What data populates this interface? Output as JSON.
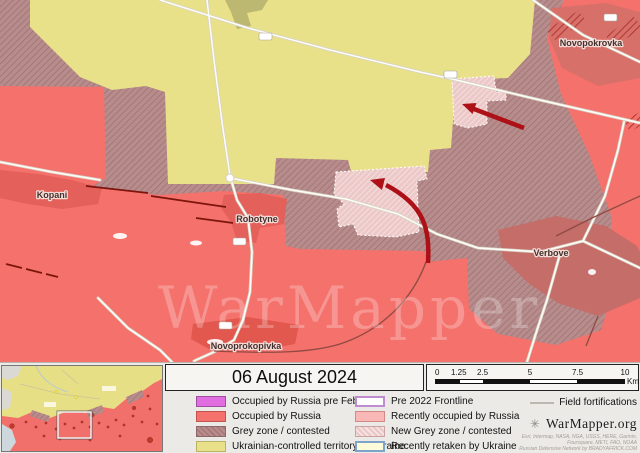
{
  "map": {
    "watermark": "WarMapper",
    "labels": {
      "kopani": "Kopani",
      "robotyne": "Robotyne",
      "novoprokopivka": "Novoprokopivka",
      "verbove": "Verbove",
      "novopokrovka": "Novopokrovka"
    },
    "colors": {
      "ukraine_controlled": "#e8e18a",
      "occupied": "#f4716c",
      "grey_zone": "#b68c8c",
      "new_grey_zone": "#ecc9c8",
      "arrow": "#ad1016",
      "fortification": "#7d150c"
    }
  },
  "legend": {
    "title": "06 August 2024",
    "left_items": [
      {
        "label": "Occupied by Russia pre Feb 2022",
        "color": "#e06ee0"
      },
      {
        "label": "Occupied by Russia",
        "color": "#f4716c"
      },
      {
        "label": "Grey zone / contested",
        "color": "#b68c8c"
      },
      {
        "label": "Ukrainian-controlled territory in Ukraine",
        "color": "#e8e18a"
      }
    ],
    "right_items": [
      {
        "label": "Pre 2022 Frontline",
        "color": "#ffffff",
        "border": "#c08cd0"
      },
      {
        "label": "Recently occupied by Russia",
        "color": "#f9b8b5"
      },
      {
        "label": "New Grey zone / contested",
        "color": "#ecc9c8"
      },
      {
        "label": "Recently retaken by Ukraine",
        "color": "#fdfbda",
        "border": "#7ea4cc"
      }
    ],
    "fortifications_label": "Field fortifications",
    "brand": "WarMapper.org",
    "credits": [
      "Esri, Intermap, NASA, NGA, USGS, HERE, Garmin,",
      "Foursquare, METI, FAO, NOAA",
      "Russian Defensive Network by BRADYAFRICK.COM"
    ]
  },
  "scalebar": {
    "ticks": [
      "0",
      "1.25",
      "2.5",
      "5",
      "7.5",
      "10"
    ],
    "unit": "Km"
  }
}
